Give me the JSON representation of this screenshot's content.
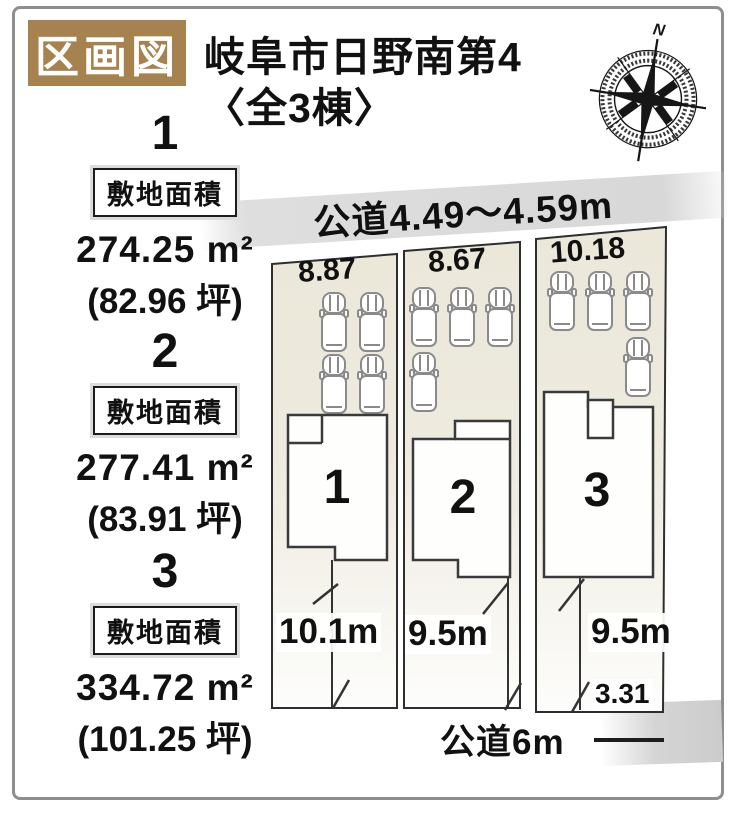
{
  "page": {
    "tag_label": "区画図",
    "title_line1": "岐阜市日野南第4",
    "title_line2": "〈全3棟〉",
    "compass_n": "N"
  },
  "site_list": [
    {
      "num": "1",
      "area_label": "敷地面積",
      "area": "274.25 m²",
      "tsubo": "(82.96 坪)"
    },
    {
      "num": "2",
      "area_label": "敷地面積",
      "area": "277.41 m²",
      "tsubo": "(83.91 坪)"
    },
    {
      "num": "3",
      "area_label": "敷地面積",
      "area": "334.72 m²",
      "tsubo": "(101.25 坪)"
    }
  ],
  "diagram": {
    "road_top_label": "公道4.49～4.59m",
    "road_bottom_label": "公道6m",
    "plots": [
      {
        "number": "1",
        "frontage": "8.87",
        "depth": "10.1m"
      },
      {
        "number": "2",
        "frontage": "8.67",
        "depth": "9.5m"
      },
      {
        "number": "3",
        "frontage": "10.18",
        "depth": "9.5m",
        "extra_dim": "3.31"
      }
    ],
    "colors": {
      "accent_brown": "#a6824f",
      "plot_fill": "#ebe8da",
      "road_band_gray": "#d9d9d9",
      "line_black": "#2e2e2e"
    }
  }
}
